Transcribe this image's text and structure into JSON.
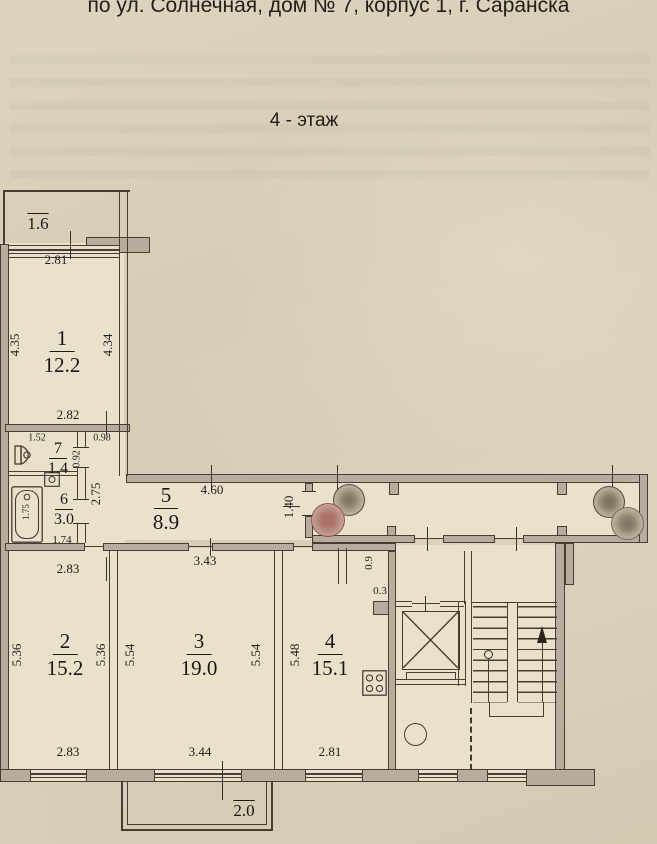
{
  "title": {
    "address": "по ул. Солнечная, дом № 7, корпус 1, г. Саранска",
    "floor": "4 - этаж"
  },
  "rooms": {
    "r1": {
      "num": "1",
      "area": "12.2"
    },
    "r2": {
      "num": "2",
      "area": "15.2"
    },
    "r3": {
      "num": "3",
      "area": "19.0"
    },
    "r4": {
      "num": "4",
      "area": "15.1"
    },
    "r5": {
      "num": "5",
      "area": "8.9"
    },
    "r6": {
      "num": "6",
      "area": "3.0"
    },
    "r7": {
      "num": "7",
      "area": "1.4"
    }
  },
  "dims": {
    "r1_top": "2.81",
    "r1_left": "4.35",
    "r1_right": "4.34",
    "r1_bottom": "2.82",
    "r7_top": "1.52",
    "r7_right": "0.92",
    "hall_width": "0.98",
    "r6_tub": "1.75",
    "r6_bottom": "1.74",
    "r5_left": "2.75",
    "r5_top": "4.60",
    "r5_right": "1.40",
    "r2_top": "2.83",
    "r2_left": "5.36",
    "r2_right": "5.36",
    "r2_bottom": "2.83",
    "r3_top": "3.43",
    "r3_left": "5.54",
    "r3_right": "5.54",
    "r3_bottom": "3.44",
    "r4_left": "5.48",
    "r4_bottom": "2.81",
    "r4_niche_h": "0.9",
    "r4_niche_w": "0.3"
  },
  "balconies": {
    "top_area": "1.6",
    "bottom_area": "2.0"
  },
  "icons": [
    "toilet-icon",
    "sink-icon",
    "bathtub-icon",
    "stove-icon",
    "elevator-icon",
    "stairs-icon",
    "garbage-chute-icon",
    "stair-direction-arrow",
    "stamp-circle"
  ],
  "colors": {
    "paper": "#d8cfba",
    "interior": "#e9e1cc",
    "wall": "#b8ad9d",
    "line": "#473d31",
    "ink": "#221c15",
    "stamp_red": "#93443a"
  }
}
